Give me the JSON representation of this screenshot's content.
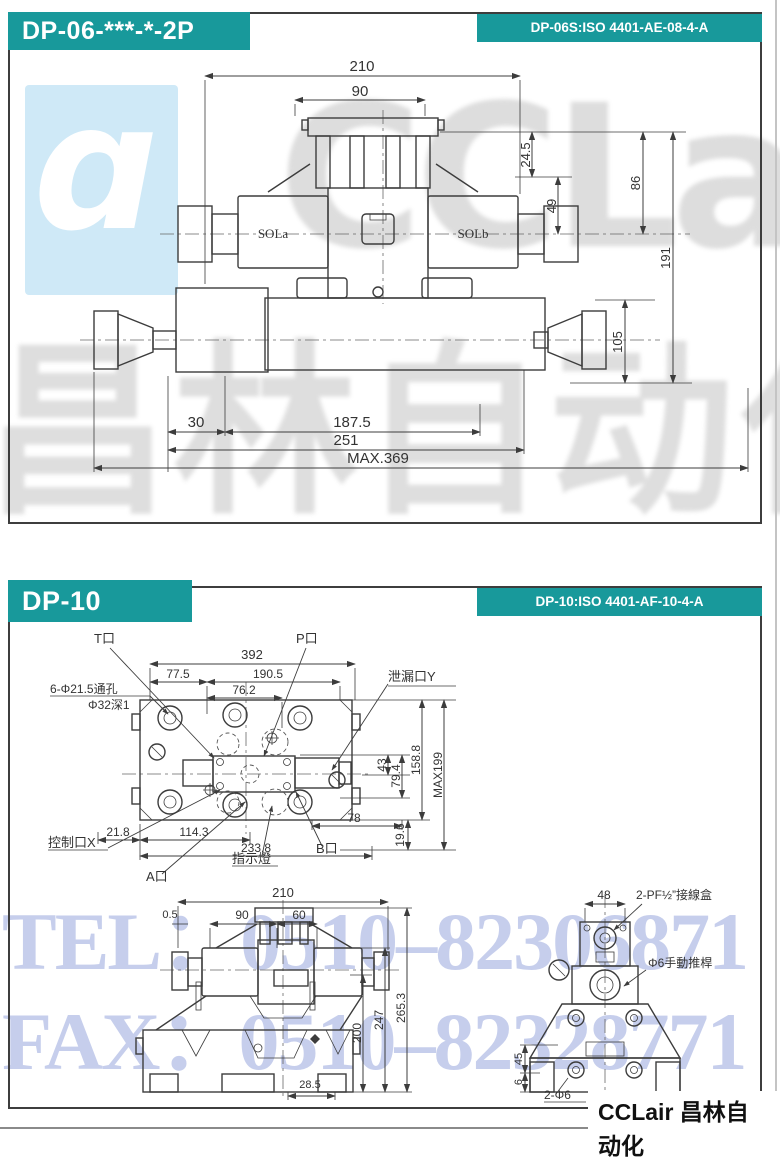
{
  "colors": {
    "teal": "#18999b",
    "watermark_blue": "#b9c3e8",
    "logo_bg": "#cfe9f7"
  },
  "watermarks": {
    "logo_glyph": "ɑ",
    "brand_en": "CCLair",
    "brand_cn": "昌林自动化",
    "tel": "TEL：0510–82306871",
    "fax": "FAX：0510–82328771"
  },
  "footer": {
    "brand": "CCLair 昌林自动化"
  },
  "dp06": {
    "title": "DP-06-***-*-2P",
    "standard": "DP-06S:ISO 4401-AE-08-4-A",
    "labels": {
      "sol_a": "SOLa",
      "sol_b": "SOLb"
    },
    "dims": {
      "width_total": "210",
      "width_top": "90",
      "h_top": "24.5",
      "h_sol": "49",
      "h_upper": "86",
      "h_total": "191",
      "h_lower": "105",
      "len_offset": "30",
      "len_body": "187.5",
      "len_valve": "251",
      "len_max": "MAX.369"
    }
  },
  "dp10": {
    "title": "DP-10",
    "standard": "DP-10:ISO 4401-AF-10-4-A",
    "top_view": {
      "labels": {
        "port_t": "T口",
        "port_p": "P口",
        "leak_y": "泄漏口Y",
        "through_holes": "6-Φ21.5通孔",
        "hole_depth": "Φ32深1",
        "control_x": "控制口X",
        "port_a": "A口",
        "indicator": "指示燈",
        "port_b": "B口"
      },
      "dims": {
        "w392": "392",
        "w77_5": "77.5",
        "w190_5": "190.5",
        "w76_2": "76.2",
        "h43": "43",
        "h79_4": "79.4",
        "h158_8": "158.8",
        "hmax": "MAX199",
        "w78": "78",
        "h19_6": "19.6",
        "w21_8": "21.8",
        "w114_3": "114.3",
        "w233_8": "233.8"
      }
    },
    "front_view": {
      "dims": {
        "w210": "210",
        "w0_5": "0.5",
        "w90": "90",
        "w60": "60",
        "h200": "200",
        "h247": "247",
        "h265_3": "265.3",
        "w28_5": "28.5"
      }
    },
    "side_view": {
      "labels": {
        "junction_box": "2-PF½”接線盒",
        "push_rod": "Φ6手動推桿",
        "feet_holes": "2-Φ6"
      },
      "dims": {
        "w48": "48",
        "h45": "45",
        "h6": "6"
      }
    }
  }
}
